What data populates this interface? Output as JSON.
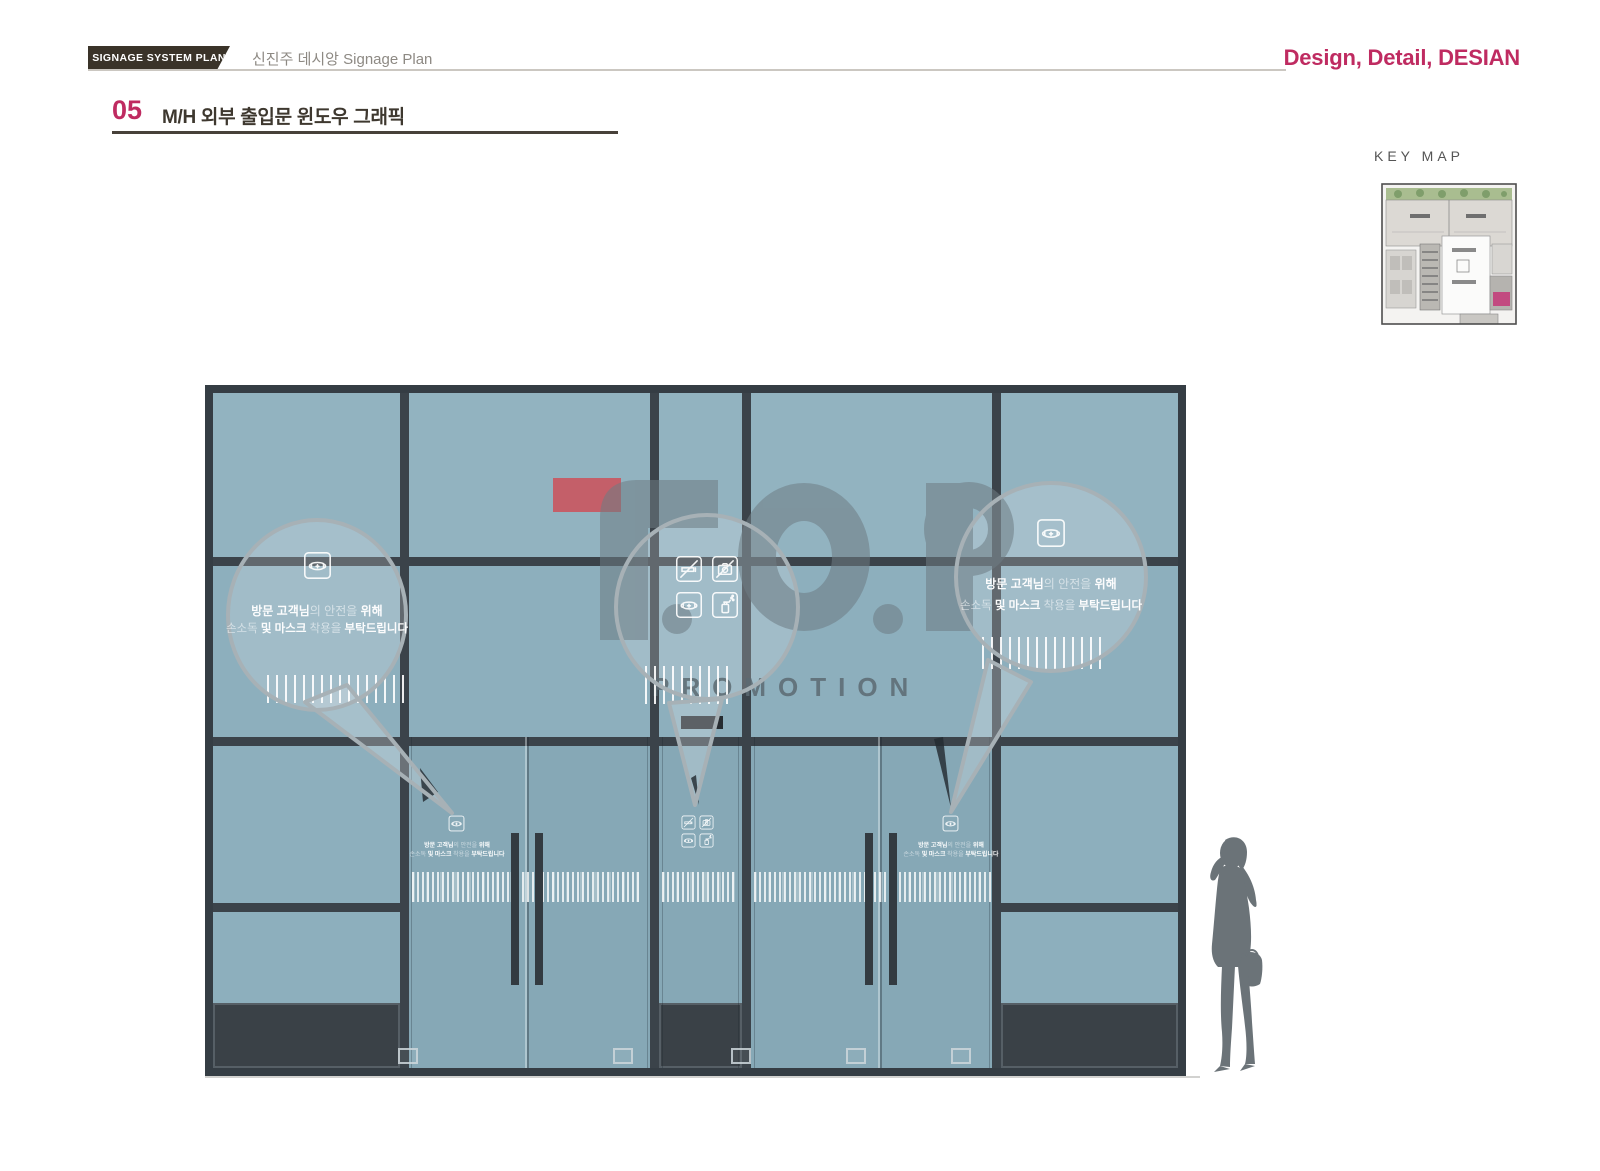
{
  "header": {
    "badge": "SIGNAGE SYSTEM PLAN",
    "subtitle": "신진주 데시앙 Signage Plan",
    "brand": "Design, Detail, DESIAN"
  },
  "section": {
    "number": "05",
    "title": "M/H 외부 출입문 윈도우 그래픽"
  },
  "key_map": {
    "label": "KEY MAP"
  },
  "watermark": {
    "logo": "F.O.P",
    "sub": "PROMOTION"
  },
  "bubble": {
    "line1_a": "방문 고객님",
    "line1_b": "의 ",
    "line1_c": "안전을 ",
    "line1_d": "위해",
    "line2_a": "손소독 ",
    "line2_b": "및 마스크 ",
    "line2_c": "착용을 ",
    "line2_d": "부탁드립니다"
  },
  "icons": {
    "bubble_left": "mask-icon",
    "bubble_center": [
      "no-smoking-icon",
      "no-camera-icon",
      "mask-icon",
      "sanitizer-icon"
    ],
    "bubble_right": "mask-icon"
  },
  "colors": {
    "accent_magenta": "#bf2b61",
    "badge_brown": "#3a3329",
    "glass_blue": "#8dafbd",
    "frame_dark": "#3b434a",
    "red_marker": "#c45f69",
    "watermark_gray": "#6e7c84",
    "keymap_magenta": "#c24a80"
  }
}
